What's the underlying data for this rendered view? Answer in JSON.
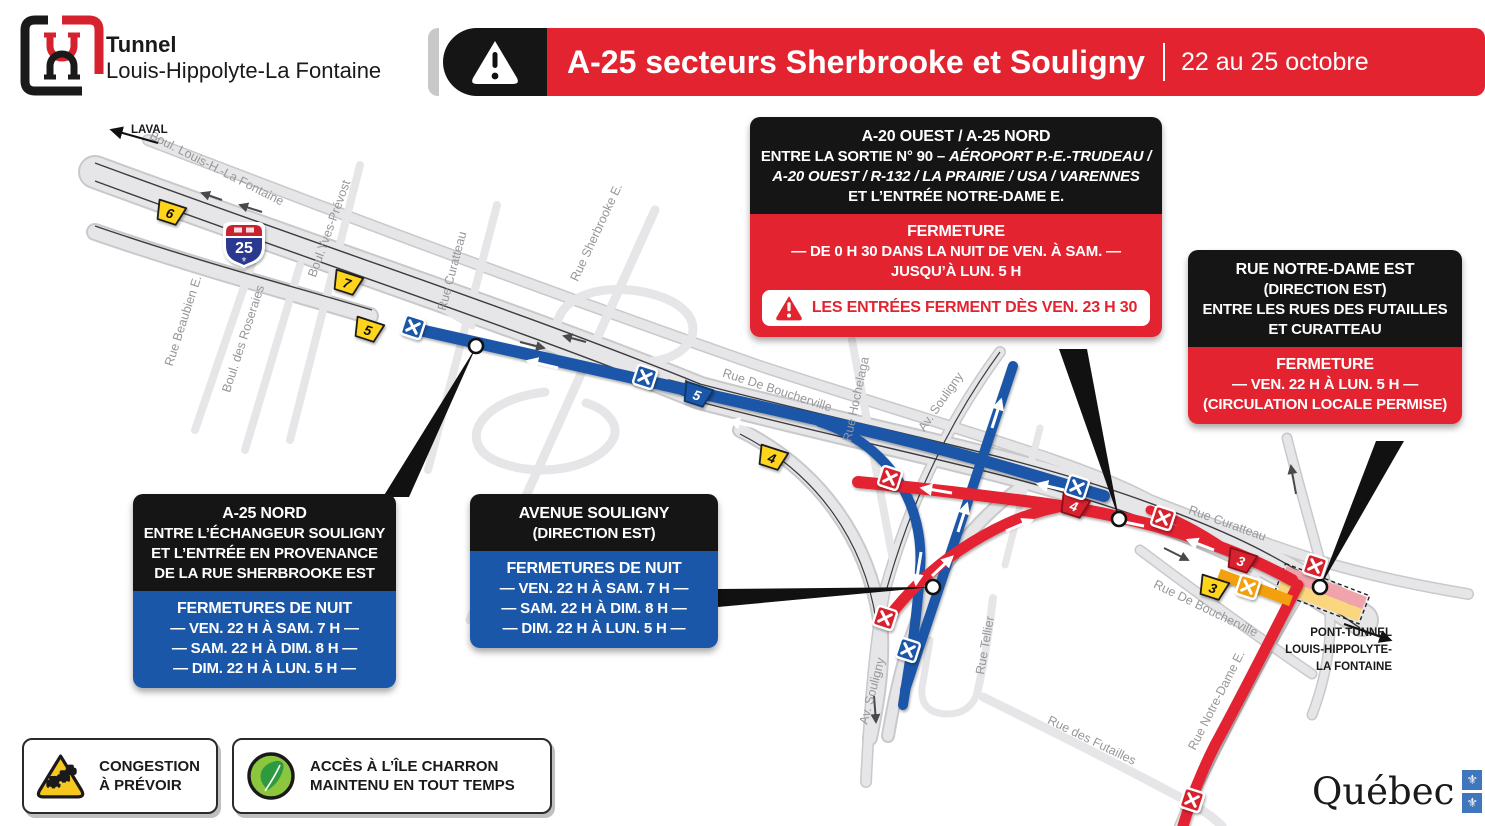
{
  "header": {
    "tunnel_name": [
      "Tunnel",
      "Louis-Hippolyte-La Fontaine"
    ],
    "banner_title": "A-25 secteurs Sherbrooke et Souligny",
    "banner_dates": "22 au 25 octobre"
  },
  "callouts": {
    "a20": {
      "title": "A-20 OUEST / A-25 NORD",
      "line1_normal": "ENTRE LA SORTIE N° 90 – ",
      "line1_italic": "AÉROPORT P.-E.-TRUDEAU /",
      "line2_italic": "A-20 OUEST / R-132 / LA PRAIRIE / USA / VARENNES",
      "line3": "ET L’ENTRÉE NOTRE-DAME E.",
      "closure_title": "FERMETURE",
      "closure_lines": [
        "— DE 0 H 30 DANS LA NUIT DE VEN. À SAM. —",
        "JUSQU’À LUN. 5 H"
      ],
      "alert": "LES ENTRÉES FERMENT DÈS VEN. 23 H 30"
    },
    "notre_dame": {
      "title_lines": [
        "RUE NOTRE-DAME EST",
        "(DIRECTION EST)",
        "ENTRE LES RUES DES FUTAILLES",
        "ET CURATTEAU"
      ],
      "closure_title": "FERMETURE",
      "closure_lines": [
        "— VEN. 22 H À LUN. 5 H —",
        "(CIRCULATION LOCALE PERMISE)"
      ]
    },
    "a25_nord": {
      "title_lines": [
        "A-25 NORD",
        "ENTRE L’ÉCHANGEUR SOULIGNY",
        "ET L’ENTRÉE EN PROVENANCE",
        "DE LA RUE SHERBROOKE EST"
      ],
      "closure_title": "FERMETURES DE NUIT",
      "closure_lines": [
        "— VEN. 22 H À SAM. 7 H —",
        "— SAM. 22 H À DIM. 8 H —",
        "— DIM. 22 H À LUN. 5 H —"
      ]
    },
    "souligny": {
      "title_lines": [
        "AVENUE SOULIGNY",
        "(DIRECTION EST)"
      ],
      "closure_title": "FERMETURES DE NUIT",
      "closure_lines": [
        "— VEN. 22 H À SAM. 7 H —",
        "— SAM. 22 H À DIM. 8 H —",
        "— DIM. 22 H À LUN. 5 H —"
      ]
    }
  },
  "legend": {
    "items": [
      {
        "icon": "congestion-icon",
        "lines": [
          "CONGESTION",
          "À PRÉVOIR"
        ]
      },
      {
        "icon": "leaf-icon",
        "lines": [
          "ACCÈS À L’ÎLE CHARRON",
          "MAINTENU EN TOUT TEMPS"
        ]
      }
    ]
  },
  "map": {
    "laval": "LAVAL",
    "tunnel_label": [
      "PONT-TUNNEL",
      "LOUIS-HIPPOLYTE-",
      "LA FONTAINE"
    ],
    "shield_number": "25",
    "road_labels": [
      {
        "t": "Boul. Louis-H.-La Fontaine",
        "x": 215,
        "y": 172,
        "r": 27
      },
      {
        "t": "Rue Beaubien E.",
        "x": 187,
        "y": 322,
        "r": -72
      },
      {
        "t": "Boul. des Roseraies",
        "x": 247,
        "y": 340,
        "r": -72
      },
      {
        "t": "Boul.Yves-Prévost",
        "x": 333,
        "y": 230,
        "r": -70
      },
      {
        "t": "Rue Curatteau",
        "x": 456,
        "y": 272,
        "r": -75
      },
      {
        "t": "Rue Sherbrooke E.",
        "x": 600,
        "y": 234,
        "r": -65
      },
      {
        "t": "Rue De Boucherville",
        "x": 776,
        "y": 394,
        "r": 18
      },
      {
        "t": "Rue Hochelaga",
        "x": 860,
        "y": 400,
        "r": -78
      },
      {
        "t": "Av. Souligny",
        "x": 944,
        "y": 404,
        "r": -55
      },
      {
        "t": "Rue Curatteau",
        "x": 1226,
        "y": 527,
        "r": 20
      },
      {
        "t": "Rue De Boucherville",
        "x": 1204,
        "y": 612,
        "r": 26
      },
      {
        "t": "Rue Tellier",
        "x": 989,
        "y": 646,
        "r": -80
      },
      {
        "t": "Av. Souligny",
        "x": 876,
        "y": 692,
        "r": -75
      },
      {
        "t": "Rue des Futailles",
        "x": 1090,
        "y": 744,
        "r": 26
      },
      {
        "t": "Rue Notre-Dame E.",
        "x": 1220,
        "y": 702,
        "r": -63
      }
    ],
    "exit_tabs": [
      {
        "n": "6",
        "c": "yellow",
        "x": 170,
        "y": 213
      },
      {
        "n": "7",
        "c": "yellow",
        "x": 347,
        "y": 283
      },
      {
        "n": "5",
        "c": "yellow",
        "x": 368,
        "y": 330
      },
      {
        "n": "5",
        "c": "blue",
        "x": 697,
        "y": 395
      },
      {
        "n": "4",
        "c": "yellow",
        "x": 772,
        "y": 458
      },
      {
        "n": "4",
        "c": "red",
        "x": 1074,
        "y": 506
      },
      {
        "n": "3",
        "c": "red",
        "x": 1241,
        "y": 561
      },
      {
        "n": "3",
        "c": "yellow",
        "x": 1213,
        "y": 588
      }
    ],
    "closed_x": [
      {
        "c": "blue",
        "x": 413,
        "y": 327
      },
      {
        "c": "blue",
        "x": 645,
        "y": 377
      },
      {
        "c": "blue",
        "x": 1077,
        "y": 487
      },
      {
        "c": "blue",
        "x": 908,
        "y": 650
      },
      {
        "c": "red",
        "x": 890,
        "y": 478
      },
      {
        "c": "red",
        "x": 885,
        "y": 618
      },
      {
        "c": "red",
        "x": 1163,
        "y": 518
      },
      {
        "c": "red",
        "x": 1315,
        "y": 566
      },
      {
        "c": "red",
        "x": 1192,
        "y": 800
      },
      {
        "c": "amber",
        "x": 1248,
        "y": 587
      }
    ]
  },
  "footer": {
    "wordmark": "Québec"
  },
  "colors": {
    "red": "#e32330",
    "blue": "#1b57a8",
    "yellow": "#ffd41e",
    "amber": "#f2a007"
  }
}
